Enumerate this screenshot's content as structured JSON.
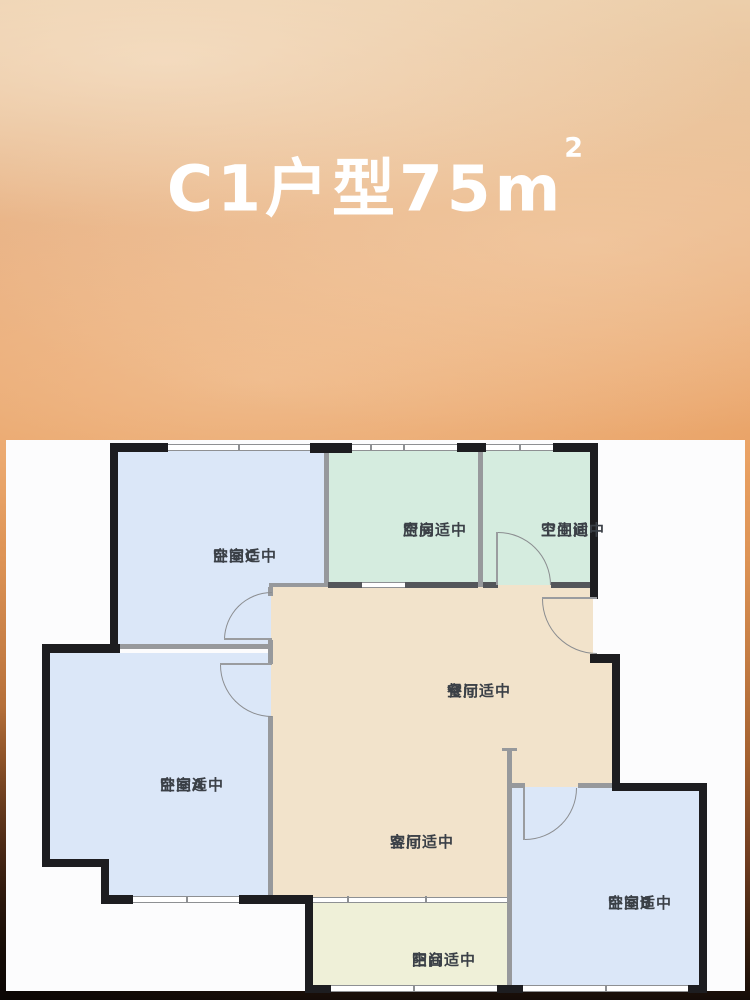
{
  "title": {
    "full": "C1户型75m²",
    "main": "C1户型75m",
    "sup": "2",
    "color": "#ffffff"
  },
  "floor_plan": {
    "rooms": [
      {
        "id": "bedroom-c",
        "name": "卧室C",
        "note": "空间适中",
        "fill": "#dbe7f8"
      },
      {
        "id": "kitchen",
        "name": "厨房",
        "note": "空间适中",
        "fill": "#d5ecdf"
      },
      {
        "id": "bathroom",
        "name": "卫生间",
        "note": "空间适中",
        "fill": "#d5ecdf"
      },
      {
        "id": "dining",
        "name": "餐厅",
        "note": "空间适中",
        "fill": "#f2e3cb"
      },
      {
        "id": "bedroom-a",
        "name": "卧室A",
        "note": "空间适中",
        "fill": "#dbe7f8"
      },
      {
        "id": "living",
        "name": "客厅",
        "note": "空间适中",
        "fill": "#f2e3cb"
      },
      {
        "id": "bedroom-b",
        "name": "卧室B",
        "note": "空间适中",
        "fill": "#dbe7f8"
      },
      {
        "id": "balcony",
        "name": "阳台",
        "note": "空间适中",
        "fill": "#eff0d8"
      }
    ],
    "wall_colors": {
      "exterior": "#1d1d20",
      "interior": "#97999c"
    },
    "label_color": "#3b4047",
    "panel_bg": "#fcfcfd",
    "sky_top": "#ecceaa",
    "sky_mid": "#e9a062",
    "sky_bottom": "#150c08"
  }
}
